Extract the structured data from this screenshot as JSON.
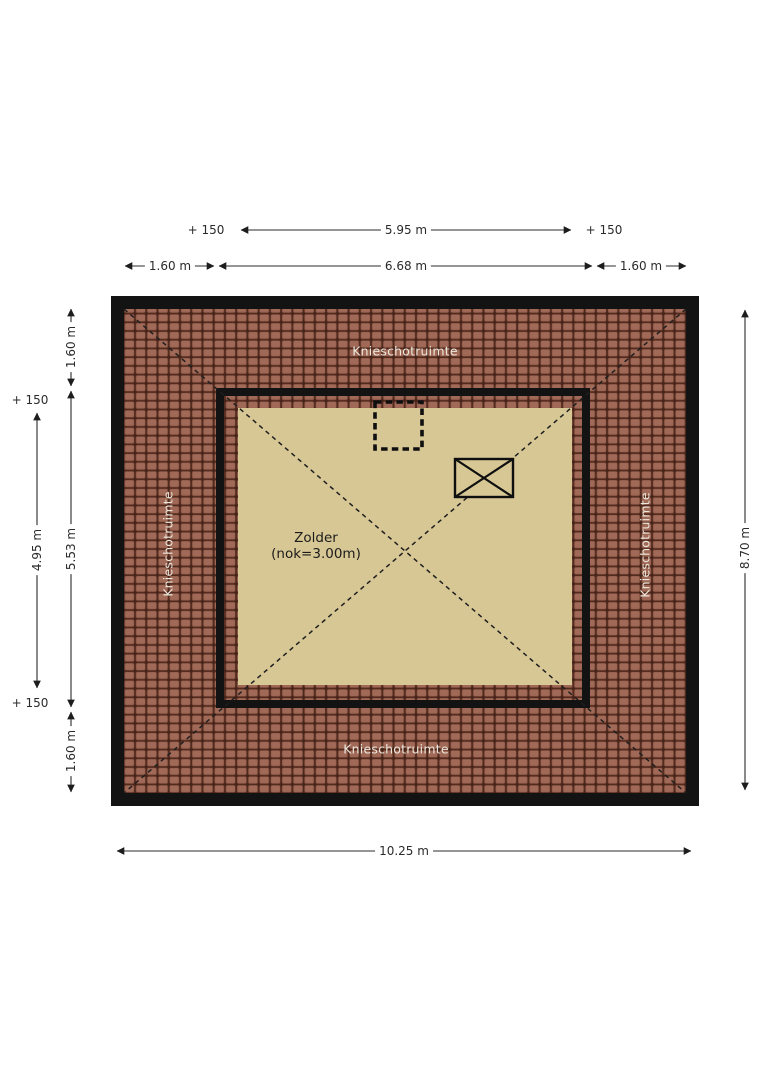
{
  "room": {
    "label": "Zolder",
    "ridge_height": "(nok=3.00m)"
  },
  "area_labels": {
    "top": "Knieschotruimte",
    "bottom": "Knieschotruimte",
    "left": "Knieschotruimte",
    "right": "Knieschotruimte"
  },
  "dimensions": {
    "top_row": {
      "plus_left": "+ 150",
      "width": "5.95 m",
      "plus_right": "+ 150"
    },
    "second_row": {
      "left": "1.60 m",
      "middle": "6.68 m",
      "right": "1.60 m"
    },
    "left_outer": {
      "plus_top": "+ 150",
      "height": "4.95 m",
      "plus_bottom": "+ 150"
    },
    "left_inner": {
      "top": "1.60 m",
      "middle": "5.53 m",
      "bottom": "1.60 m"
    },
    "right": {
      "height": "8.70 m"
    },
    "bottom": {
      "width": "10.25 m"
    }
  },
  "colors": {
    "roof_tiles": "#9d6654",
    "tile_joint": "#45231a",
    "floor": "#d7c795",
    "walls": "#131313",
    "dimension_text": "#2b2b2b",
    "area_label_text": "#ece7dc",
    "page_background": "#ffffff"
  },
  "symbols": {
    "roof_window": "rectangle-with-x-icon",
    "shaft": "dashed-square-outline-icon"
  }
}
